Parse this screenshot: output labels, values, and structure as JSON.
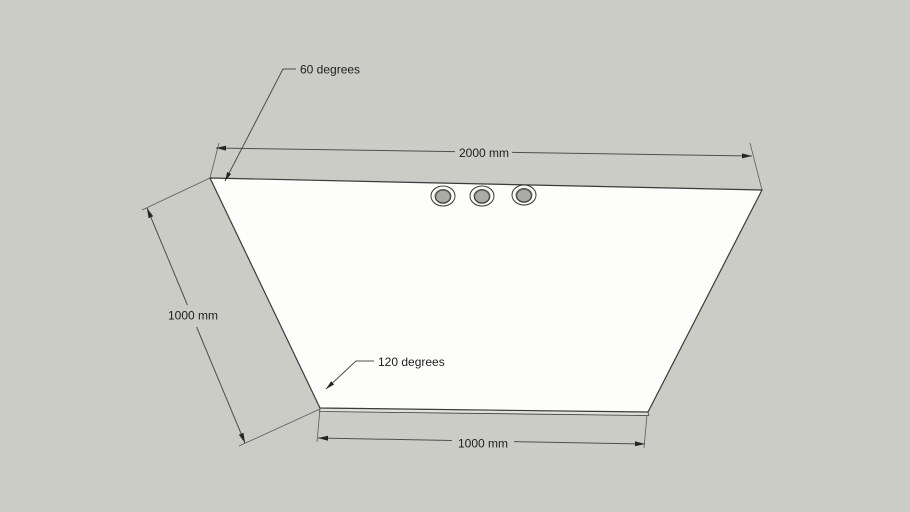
{
  "viewer": {
    "colors": {
      "background": "#cbccc6",
      "panel_face": "#fdfdfc",
      "panel_side": "#e1e1db",
      "hole_rim": "#fbfbf9",
      "hole_bore": "#a9aba4",
      "edge": "#3a3a3a",
      "dimension_line": "#4e4e4e",
      "text": "#1e1e1e"
    },
    "model": {
      "hole_count": 3
    },
    "annotations": {
      "top_width_label": "2000 mm",
      "left_length_label": "1000 mm",
      "bottom_width_label": "1000 mm",
      "top_left_angle_label": "60 degrees",
      "bottom_left_angle_label": "120 degrees"
    }
  }
}
